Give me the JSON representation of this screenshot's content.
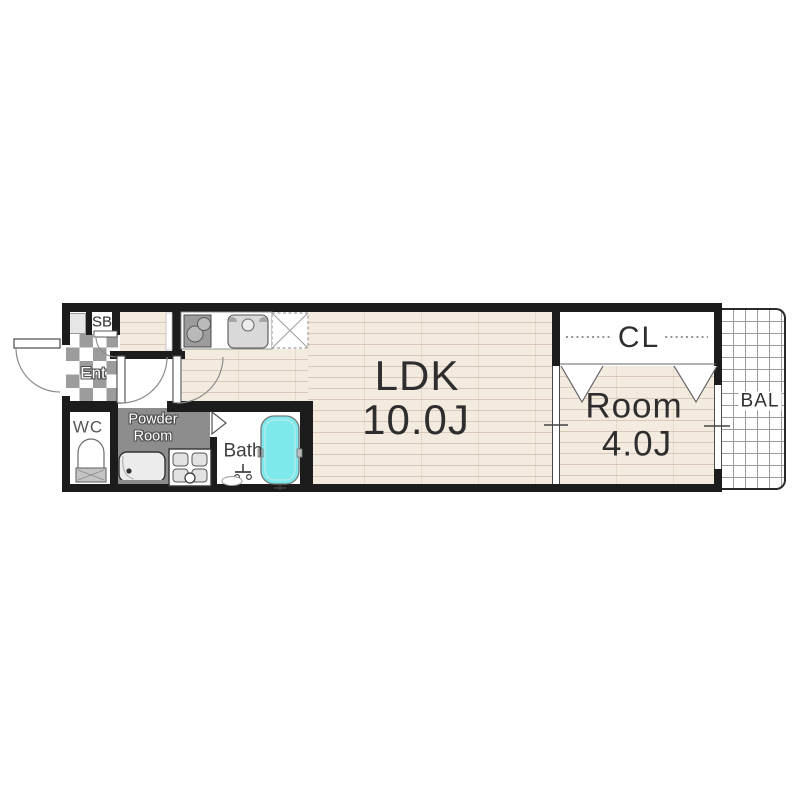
{
  "floorplan": {
    "type": "apartment-1LDK-floor-plan",
    "rooms": {
      "ldk": {
        "label": "LDK",
        "size": "10.0J"
      },
      "bedroom": {
        "label": "Room",
        "size": "4.0J"
      },
      "closet": {
        "label": "CL"
      },
      "balcony": {
        "label": "BAL"
      },
      "toilet": {
        "label": "WC"
      },
      "bath": {
        "label": "Bath"
      },
      "powder": {
        "line1": "Powder",
        "line2": "Room"
      },
      "entrance": {
        "label": "Ent"
      },
      "shoebox": {
        "label": "SB"
      }
    },
    "colors": {
      "wall": "#1c1c1c",
      "wood_floor": "#f4ebe0",
      "entrance_tile_gray": "#9c9c9c",
      "powder_floor": "#8d8d8d",
      "bathtub": "#7de9ea",
      "text": "#2e2e2e"
    },
    "icons": [
      "stove-icon",
      "kitchen-sink-icon",
      "refrigerator-space-icon",
      "toilet-icon",
      "bathtub-icon",
      "shower-faucet-icon",
      "vanity-sink-icon",
      "washer-pan-icon",
      "door-swing-icon",
      "folding-door-icon",
      "sliding-window-icon"
    ]
  }
}
